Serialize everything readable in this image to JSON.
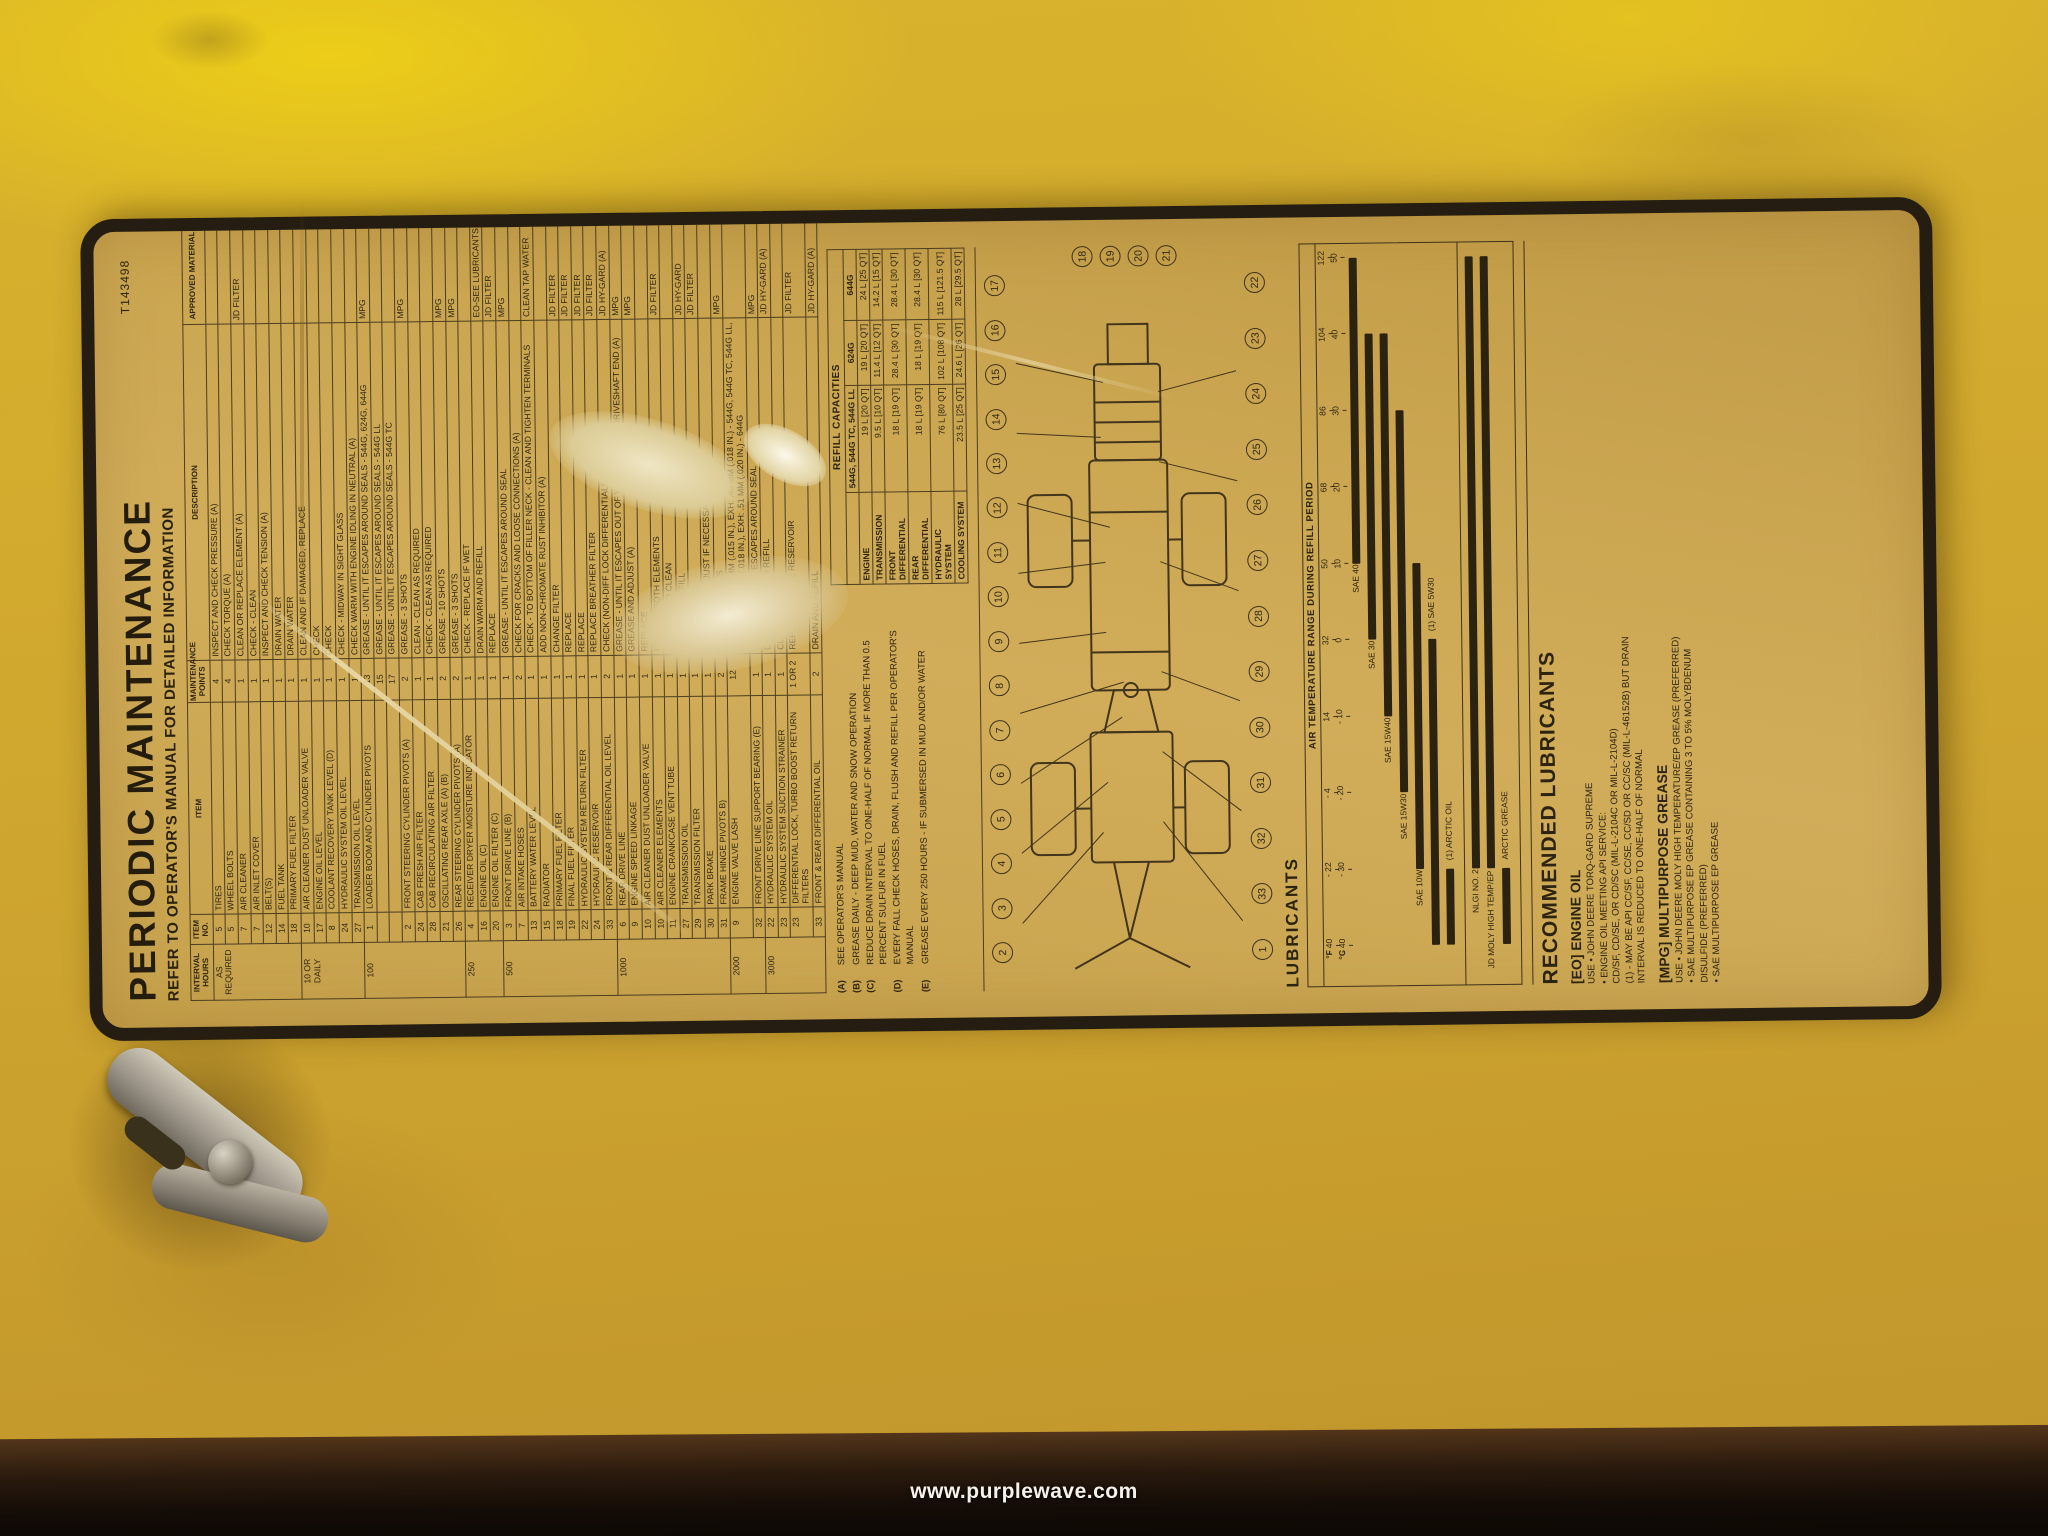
{
  "photo": {
    "watermark": "www.purplewave.com",
    "colors": {
      "panel_yellow": "#d3ab2e",
      "decal_background": "#cba651",
      "decal_border": "#251d11",
      "ink": "#2c2310",
      "table_edge_dark": "#120b06"
    }
  },
  "decal": {
    "part_number": "T143498",
    "title": "PERIODIC MAINTENANCE",
    "subtitle": "REFER TO OPERATOR'S MANUAL FOR DETAILED INFORMATION",
    "maintenance": {
      "headers": {
        "interval": "INTERVAL HOURS",
        "item_no": "ITEM NO.",
        "item": "ITEM",
        "points": "MAINTENANCE POINTS",
        "description": "DESCRIPTION",
        "material": "APPROVED MATERIAL"
      },
      "groups": [
        {
          "interval": "AS REQUIRED",
          "rows": [
            {
              "no": "5",
              "item": "TIRES",
              "pts": "4",
              "desc": "INSPECT AND CHECK PRESSURE (A)",
              "mat": ""
            },
            {
              "no": "5",
              "item": "WHEEL BOLTS",
              "pts": "4",
              "desc": "CHECK TORQUE (A)",
              "mat": ""
            },
            {
              "no": "7",
              "item": "AIR CLEANER",
              "pts": "1",
              "desc": "CLEAN OR REPLACE ELEMENT (A)",
              "mat": "JD FILTER"
            },
            {
              "no": "7",
              "item": "AIR INLET COVER",
              "pts": "1",
              "desc": "CHECK - CLEAN",
              "mat": ""
            },
            {
              "no": "12",
              "item": "BELT(S)",
              "pts": "1",
              "desc": "INSPECT AND CHECK TENSION (A)",
              "mat": ""
            },
            {
              "no": "14",
              "item": "FUEL TANK",
              "pts": "1",
              "desc": "DRAIN WATER",
              "mat": ""
            },
            {
              "no": "18",
              "item": "PRIMARY FUEL FILTER",
              "pts": "1",
              "desc": "DRAIN WATER",
              "mat": ""
            }
          ]
        },
        {
          "interval": "10 OR DAILY",
          "rows": [
            {
              "no": "10",
              "item": "AIR CLEANER DUST UNLOADER VALVE",
              "pts": "1",
              "desc": "CLEAN AND IF DAMAGED, REPLACE",
              "mat": ""
            },
            {
              "no": "17",
              "item": "ENGINE OIL LEVEL",
              "pts": "1",
              "desc": "CHECK",
              "mat": ""
            },
            {
              "no": "8",
              "item": "COOLANT RECOVERY TANK LEVEL (D)",
              "pts": "1",
              "desc": "CHECK",
              "mat": ""
            },
            {
              "no": "24",
              "item": "HYDRAULIC SYSTEM OIL LEVEL",
              "pts": "1",
              "desc": "CHECK - MIDWAY IN SIGHT GLASS",
              "mat": ""
            },
            {
              "no": "27",
              "item": "TRANSMISSION OIL LEVEL",
              "pts": "1",
              "desc": "CHECK WARM WITH ENGINE IDLING IN NEUTRAL (A)",
              "mat": ""
            }
          ]
        },
        {
          "interval": "100",
          "rows": [
            {
              "no": "1",
              "item": "LOADER BOOM AND CYLINDER PIVOTS",
              "pts": "13",
              "desc": "GREASE - UNTIL IT ESCAPES AROUND SEALS - 544G, 624G, 644G",
              "mat": "MPG"
            },
            {
              "no": "",
              "item": "",
              "pts": "15",
              "desc": "GREASE - UNTIL IT ESCAPES AROUND SEALS - 544G LL",
              "mat": ""
            },
            {
              "no": "",
              "item": "",
              "pts": "17",
              "desc": "GREASE - UNTIL IT ESCAPES AROUND SEALS - 544G TC",
              "mat": ""
            },
            {
              "no": "2",
              "item": "FRONT STEERING CYLINDER PIVOTS (A)",
              "pts": "2",
              "desc": "GREASE - 3 SHOTS",
              "mat": "MPG"
            },
            {
              "no": "24",
              "item": "CAB FRESH AIR FILTER",
              "pts": "1",
              "desc": "CLEAN - CLEAN AS REQUIRED",
              "mat": ""
            },
            {
              "no": "28",
              "item": "CAB RECIRCULATING AIR FILTER",
              "pts": "1",
              "desc": "CHECK - CLEAN AS REQUIRED",
              "mat": ""
            },
            {
              "no": "21",
              "item": "OSCILLATING REAR AXLE (A) (B)",
              "pts": "2",
              "desc": "GREASE - 10 SHOTS",
              "mat": "MPG"
            },
            {
              "no": "26",
              "item": "REAR STEERING CYLINDER PIVOTS (A)",
              "pts": "2",
              "desc": "GREASE - 3 SHOTS",
              "mat": "MPG"
            }
          ]
        },
        {
          "interval": "250",
          "rows": [
            {
              "no": "4",
              "item": "RECEIVER DRYER MOISTURE INDICATOR",
              "pts": "1",
              "desc": "CHECK - REPLACE IF WET",
              "mat": ""
            },
            {
              "no": "16",
              "item": "ENGINE OIL (C)",
              "pts": "1",
              "desc": "DRAIN WARM AND REFILL",
              "mat": "EO-SEE LUBRICANTS"
            },
            {
              "no": "20",
              "item": "ENGINE OIL FILTER (C)",
              "pts": "1",
              "desc": "REPLACE",
              "mat": "JD FILTER"
            }
          ]
        },
        {
          "interval": "500",
          "rows": [
            {
              "no": "3",
              "item": "FRONT DRIVE LINE (B)",
              "pts": "1",
              "desc": "GREASE - UNTIL IT ESCAPES AROUND SEAL",
              "mat": "MPG"
            },
            {
              "no": "7",
              "item": "AIR INTAKE HOSES",
              "pts": "2",
              "desc": "CHECK FOR CRACKS AND LOOSE CONNECTIONS (A)",
              "mat": ""
            },
            {
              "no": "13",
              "item": "BATTERY WATER LEVEL",
              "pts": "1",
              "desc": "CHECK - TO BOTTOM OF FILLER NECK - CLEAN AND TIGHTEN TERMINALS",
              "mat": "CLEAN TAP WATER"
            },
            {
              "no": "15",
              "item": "RADIATOR",
              "pts": "1",
              "desc": "ADD NON-CHROMATE RUST INHIBITOR (A)",
              "mat": ""
            },
            {
              "no": "18",
              "item": "PRIMARY FUEL FILTER",
              "pts": "1",
              "desc": "CHANGE FILTER",
              "mat": "JD FILTER"
            },
            {
              "no": "19",
              "item": "FINAL FUEL FILTER",
              "pts": "1",
              "desc": "REPLACE",
              "mat": "JD FILTER"
            },
            {
              "no": "22",
              "item": "HYDRAULIC SYSTEM RETURN FILTER",
              "pts": "1",
              "desc": "REPLACE",
              "mat": "JD FILTER"
            },
            {
              "no": "24",
              "item": "HYDRAULIC RESERVOIR",
              "pts": "1",
              "desc": "REPLACE BREATHER FILTER",
              "mat": "JD FILTER"
            },
            {
              "no": "33",
              "item": "FRONT & REAR DIFFERENTIAL OIL LEVEL",
              "pts": "2",
              "desc": "CHECK (NON-DIFF LOCK DIFFERENTIALS ONLY)",
              "mat": "JD HY-GARD (A)"
            }
          ]
        },
        {
          "interval": "1000",
          "rows": [
            {
              "no": "6",
              "item": "REAR DRIVE LINE",
              "pts": "1",
              "desc": "GREASE - UNTIL IT ESCAPES OUT OF VENT HOLES IN DRIVESHAFT END (A)",
              "mat": "MPG"
            },
            {
              "no": "9",
              "item": "ENGINE SPEED LINKAGE",
              "pts": "1",
              "desc": "GREASE AND ADJUST (A)",
              "mat": "MPG"
            },
            {
              "no": "10",
              "item": "AIR CLEANER DUST UNLOADER VALVE",
              "pts": "1",
              "desc": "REPLACE",
              "mat": ""
            },
            {
              "no": "10",
              "item": "AIR CLEANER ELEMENTS",
              "pts": "1",
              "desc": "REPLACE BOTH ELEMENTS",
              "mat": "JD FILTER"
            },
            {
              "no": "11",
              "item": "ENGINE CRANKCASE VENT TUBE",
              "pts": "1",
              "desc": "REMOVE AND CLEAN",
              "mat": ""
            },
            {
              "no": "27",
              "item": "TRANSMISSION OIL",
              "pts": "1",
              "desc": "DRAIN AND REFILL",
              "mat": "JD HY-GARD"
            },
            {
              "no": "29",
              "item": "TRANSMISSION FILTER",
              "pts": "1",
              "desc": "REPLACE",
              "mat": "JD FILTER"
            },
            {
              "no": "30",
              "item": "PARK BRAKE",
              "pts": "1",
              "desc": "INSPECT AND ADJUST IF NECESSARY (A)",
              "mat": ""
            },
            {
              "no": "31",
              "item": "FRAME HINGE PIVOTS B)",
              "pts": "2",
              "desc": "GREASE - 3 SHOTS",
              "mat": "MPG"
            }
          ]
        },
        {
          "interval": "2000",
          "rows": [
            {
              "no": "9",
              "item": "ENGINE VALVE LASH",
              "pts": "12",
              "desc": "ADJUST - INT: .38 MM (.015 IN.), EXH: .46 MM (.018 IN.) - 544G, 544G TC, 544G LL, 624G / INT: .46 MM (.018 IN.), EXH: .51 MM (.020 IN.) - 644G",
              "mat": ""
            },
            {
              "no": "32",
              "item": "FRONT DRIVE LINE SUPPORT BEARING (E)",
              "pts": "1",
              "desc": "GREASE - UNTIL IT ESCAPES AROUND SEAL",
              "mat": "MPG"
            }
          ]
        },
        {
          "interval": "3000",
          "rows": [
            {
              "no": "22",
              "item": "HYDRAULIC SYSTEM OIL",
              "pts": "1",
              "desc": "DRAIN, FLUSH AND REFILL",
              "mat": "JD HY-GARD (A)"
            },
            {
              "no": "23",
              "item": "HYDRAULIC SYSTEM SUCTION STRAINER",
              "pts": "1",
              "desc": "CLEAN",
              "mat": ""
            },
            {
              "no": "23",
              "item": "DIFFERENTIAL LOCK, TURBO BOOST RETURN FILTERS",
              "pts": "1 OR 2",
              "desc": "REPLACE - INSIDE RESERVOIR",
              "mat": "JD FILTER"
            },
            {
              "no": "33",
              "item": "FRONT & REAR DIFFERENTIAL OIL",
              "pts": "2",
              "desc": "DRAIN AND REFILL",
              "mat": "JD HY-GARD (A)"
            }
          ]
        }
      ]
    },
    "footnotes": [
      {
        "code": "(A)",
        "text": "SEE OPERATOR'S MANUAL"
      },
      {
        "code": "(B)",
        "text": "GREASE DAILY - DEEP MUD, WATER AND SNOW OPERATION"
      },
      {
        "code": "(C)",
        "text": "REDUCE DRAIN INTERVAL TO ONE-HALF OF NORMAL IF MORE THAN 0.5 PERCENT SULFUR IN FUEL"
      },
      {
        "code": "(D)",
        "text": "EVERY FALL CHECK HOSES, DRAIN, FLUSH AND REFILL PER OPERATOR'S MANUAL"
      },
      {
        "code": "(E)",
        "text": "GREASE EVERY 250 HOURS - IF SUBMERSED IN MUD AND/OR WATER"
      }
    ],
    "refill": {
      "caption": "REFILL CAPACITIES",
      "columns": [
        "544G, 544G TC, 544G LL",
        "624G",
        "644G"
      ],
      "rows": [
        {
          "system": "ENGINE",
          "values": [
            "19 L [20 QT]",
            "19 L [20 QT]",
            "24 L [25 QT]"
          ]
        },
        {
          "system": "TRANSMISSION",
          "values": [
            "9.5 L [10 QT]",
            "11.4 L [12 QT]",
            "14.2 L [15 QT]"
          ]
        },
        {
          "system": "FRONT DIFFERENTIAL",
          "values": [
            "18 L [19 QT]",
            "28.4 L [30 QT]",
            "28.4 L [30 QT]"
          ]
        },
        {
          "system": "REAR DIFFERENTIAL",
          "values": [
            "18 L [19 QT]",
            "18 L [19 QT]",
            "28.4 L [30 QT]"
          ]
        },
        {
          "system": "HYDRAULIC SYSTEM",
          "values": [
            "76 L [80 QT]",
            "102 L [108 QT]",
            "115 L [121.5 QT]"
          ]
        },
        {
          "system": "COOLING SYSTEM",
          "values": [
            "23.5 L [25 QT]",
            "24.6 L [26 QT]",
            "28 L [29.5 QT]"
          ]
        }
      ]
    },
    "diagram": {
      "callouts_top": [
        "2",
        "3",
        "4",
        "5",
        "6",
        "7",
        "8",
        "9",
        "10",
        "11",
        "12",
        "13",
        "14",
        "15",
        "16",
        "17"
      ],
      "callouts_right": [
        "18",
        "19",
        "20",
        "21"
      ],
      "callouts_bottom": [
        "1",
        "33",
        "32",
        "31",
        "30",
        "29",
        "28",
        "27",
        "26",
        "25",
        "24",
        "23",
        "22"
      ]
    },
    "lubricants": {
      "section_title": "LUBRICANTS",
      "chart_title": "AIR TEMPERATURE RANGE DURING REFILL PERIOD",
      "unit_f": "°F",
      "unit_c": "°C",
      "scale_f": [
        "- 40",
        "- 22",
        "- 4",
        "14",
        "32",
        "50",
        "68",
        "86",
        "104",
        "122"
      ],
      "scale_c": [
        "- 40",
        "- 30",
        "- 20",
        "- 10",
        "0",
        "10",
        "20",
        "30",
        "40",
        "50"
      ],
      "c_min": -40,
      "c_max": 50,
      "oil_bars": [
        {
          "label": "SAE 40",
          "from": 10,
          "to": 50,
          "side": "left"
        },
        {
          "label": "SAE 30",
          "from": 0,
          "to": 40,
          "side": "left"
        },
        {
          "label": "SAE 15W40",
          "from": -10,
          "to": 40,
          "side": "left"
        },
        {
          "label": "SAE 15W30",
          "from": -20,
          "to": 30,
          "side": "left"
        },
        {
          "label": "SAE 10W",
          "from": -30,
          "to": 10,
          "side": "left"
        },
        {
          "label": "(1) SAE 5W30",
          "from": -40,
          "to": 0,
          "side": "right"
        },
        {
          "label": "(1) ARCTIC OIL",
          "from": -40,
          "to": -30,
          "side": "right"
        }
      ],
      "grease_bars": [
        {
          "label": "NLGI NO. 2",
          "from": -30,
          "to": 50,
          "side": "left"
        },
        {
          "label": "JD MOLY HIGH TEMP/EP",
          "from": -30,
          "to": 50,
          "side": "left"
        },
        {
          "label": "ARCTIC GREASE",
          "from": -40,
          "to": -30,
          "side": "right"
        }
      ]
    },
    "recommended": {
      "title": "RECOMMENDED LUBRICANTS",
      "engine_oil": {
        "heading": "[EO] ENGINE OIL",
        "lines": [
          "USE • JOHN DEERE TORQ-GARD SUPREME",
          "• ENGINE OIL MEETING API SERVICE:",
          "CD/SF, CD/SE, OR CD/SC (MIL-L-2104C OR MIL-L-2104D)",
          "(1) - MAY BE API CC/SF, CC/SE, CC/SD OR CC/SC (MIL-L-46152B) BUT DRAIN",
          "INTERVAL IS REDUCED TO ONE-HALF OF NORMAL"
        ]
      },
      "grease": {
        "heading": "[MPG] MULTIPURPOSE GREASE",
        "lines": [
          "USE • JOHN DEERE MOLY HIGH TEMPERATURE/EP GREASE (PREFERRED)",
          "• SAE MULTIPURPOSE EP GREASE CONTAINING 3 TO 5% MOLYBDENUM",
          "DISULFIDE (PREFERRED)",
          "• SAE MULTIPURPOSE EP GREASE"
        ]
      }
    }
  }
}
